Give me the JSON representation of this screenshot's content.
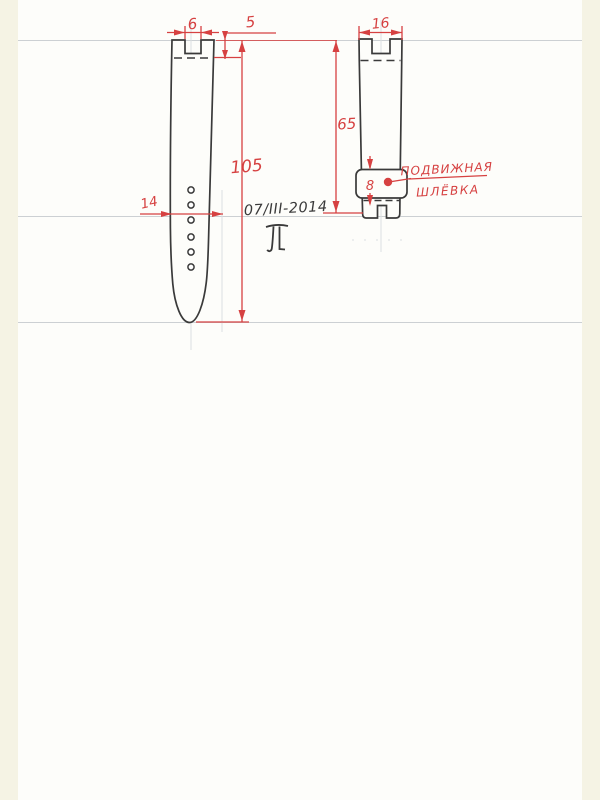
{
  "page": {
    "date_annotation": "07/III-2014",
    "dimensions": {
      "left_strap_notch_width": "6",
      "left_strap_notch_depth": "5",
      "left_strap_length": "105",
      "left_strap_width": "14",
      "right_strap_top_width": "16",
      "right_strap_length": "65",
      "keeper_height": "8"
    },
    "callout": {
      "line1": "ПОДВИЖНАЯ",
      "line2": "ШЛЁВКА"
    },
    "colors": {
      "dimension_red": "#d64141",
      "ink": "#3a3a3a",
      "paper": "#fdfdfa",
      "margin_band": "#f5f3e4",
      "fold_line": "#ccd0d3",
      "pencil_guide": "#dcdfe1"
    }
  }
}
